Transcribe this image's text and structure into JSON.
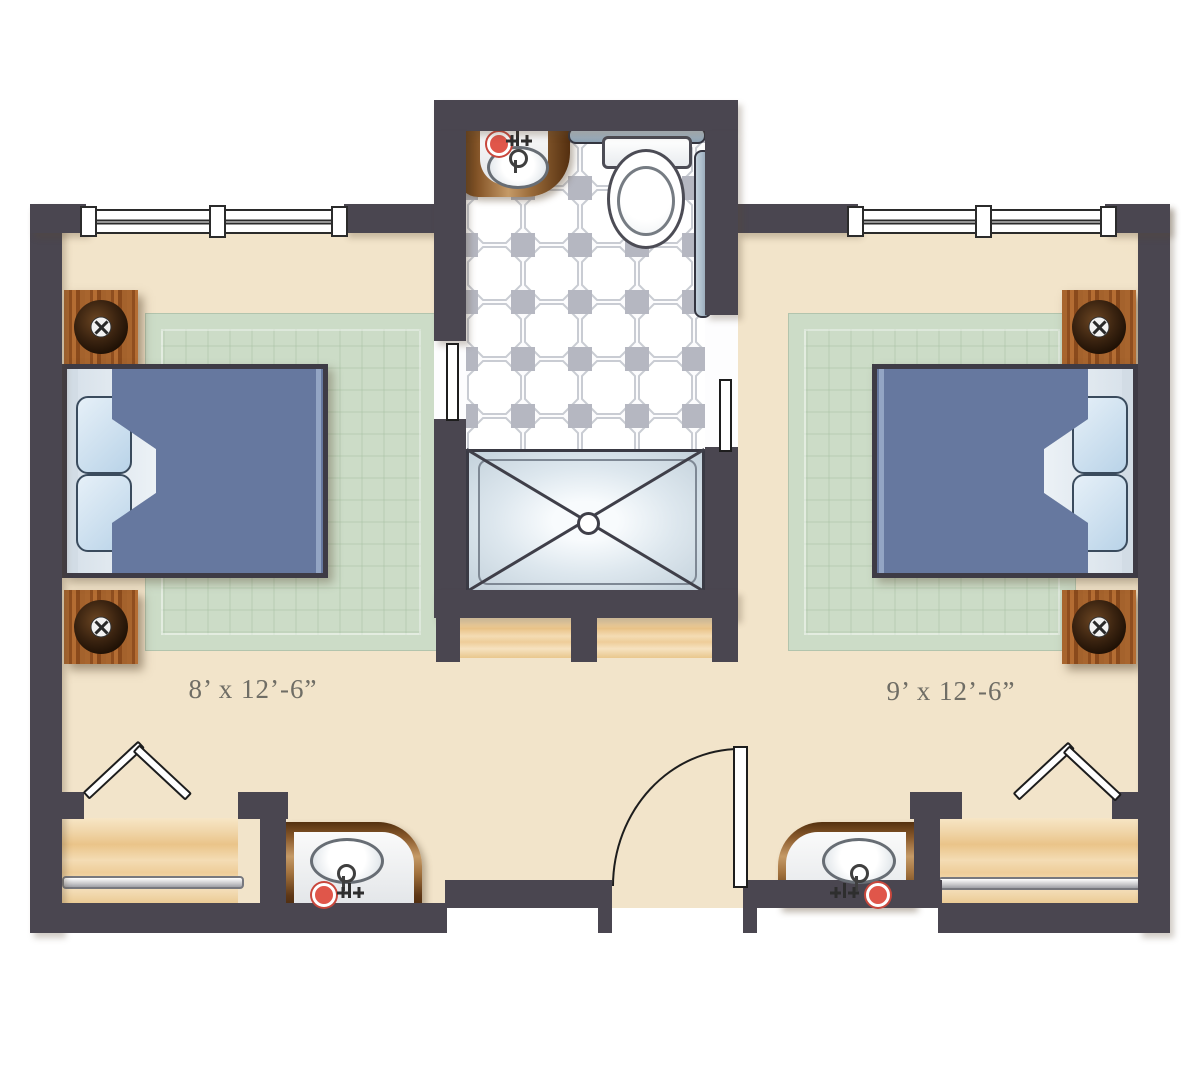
{
  "labels": {
    "left_room_dimensions": "8’ x 12’-6”",
    "right_room_dimensions": "9’ x 12’-6”"
  },
  "colors": {
    "wall": "#4a4650",
    "floor": "#f2e4ca",
    "floor_edge": "#e6d3b1",
    "rug": "#ccdcc7",
    "bed": "#66789f",
    "bed_fold": "#4e6089",
    "bed_highlight": "#93a5c4",
    "pillow_border": "#3a4b5d",
    "tile_square": "#b5b7c1",
    "closet_wood": "#f0d5a8",
    "nightstand_wood": "#a4622c",
    "shower_basin": "#dde7ee",
    "grab_bar": "#8ba0b2",
    "hot_knob": "#e0564a",
    "label_text": "#6f6d65"
  },
  "fixtures": {
    "bathroom": [
      "vanity-sink",
      "toilet",
      "grab-bars",
      "shower",
      "octagon-tile-floor"
    ],
    "left_bedroom": [
      "bed",
      "pillows",
      "nightstand",
      "lamp",
      "area-rug",
      "window",
      "closet-with-rod",
      "bifold-door",
      "vanity-sink"
    ],
    "right_bedroom": [
      "bed",
      "pillows",
      "nightstand",
      "lamp",
      "area-rug",
      "window",
      "closet-with-rod",
      "bifold-door",
      "vanity-sink"
    ],
    "entry": [
      "swing-door"
    ]
  }
}
